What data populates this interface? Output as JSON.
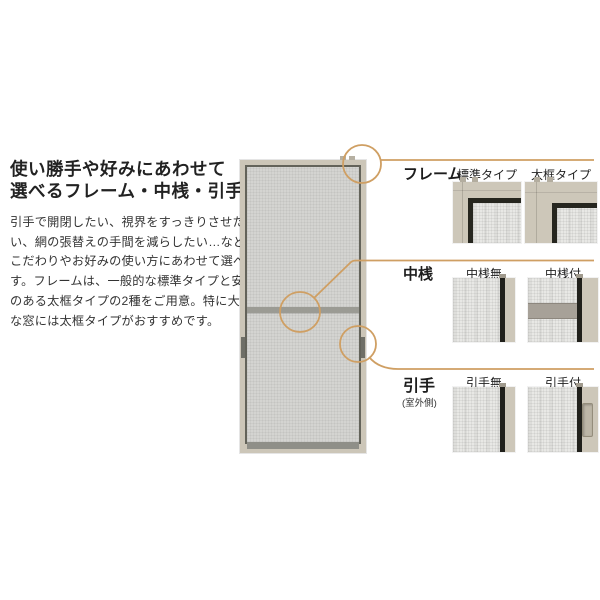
{
  "colors": {
    "accent": "#cf9f63",
    "background": "#ffffff",
    "frame_beige": "#ccc6b8",
    "mesh_gray": "#d4d4d1",
    "black_bar": "#22221d"
  },
  "intro": {
    "title_lines": [
      "使い勝手や好みにあわせて",
      "選べるフレーム・中桟・引手"
    ],
    "body_lines": [
      "引手で開閉したい、視界をすっきりさせた",
      "い、網の張替えの手間を減らしたい…など、",
      "こだわりやお好みの使い方にあわせて選べま",
      "す。フレームは、一般的な標準タイプと安心感",
      "のある太框タイプの2種をご用意。特に大き",
      "な窓には太框タイプがおすすめです。"
    ]
  },
  "sections": [
    {
      "label": "フレーム",
      "options": [
        {
          "caption": "標準タイプ"
        },
        {
          "caption": "太框タイプ"
        }
      ]
    },
    {
      "label": "中桟",
      "options": [
        {
          "caption": "中桟無"
        },
        {
          "caption": "中桟付"
        }
      ]
    },
    {
      "label": "引手",
      "sublabel": "(室外側)",
      "options": [
        {
          "caption": "引手無"
        },
        {
          "caption": "引手付"
        }
      ]
    }
  ]
}
